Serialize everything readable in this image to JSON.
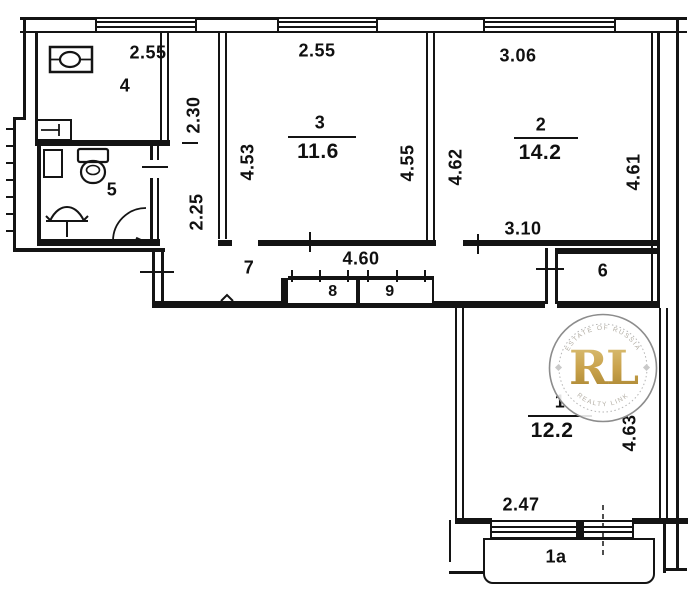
{
  "plan": {
    "rooms": {
      "kitchen": {
        "number": "4",
        "dim_top": "2.55",
        "dim_right": "2.30"
      },
      "room3": {
        "number": "3",
        "area": "11.6",
        "dim_top": "2.55",
        "dim_left": "4.53",
        "dim_right": "4.55"
      },
      "room2": {
        "number": "2",
        "area": "14.2",
        "dim_top": "3.06",
        "dim_left": "4.62",
        "dim_right": "4.61",
        "dim_bottom": "3.10"
      },
      "bathroom": {
        "number": "5"
      },
      "hallway": {
        "number": "7",
        "dim_width": "4.60",
        "dim_height": "2.25"
      },
      "closet_left": {
        "number": "8"
      },
      "closet_right": {
        "number": "9"
      },
      "storage": {
        "number": "6"
      },
      "room1": {
        "number": "1",
        "area": "12.2",
        "dim_right": "4.63",
        "dim_bottom": "2.47"
      },
      "balcony": {
        "number": "1a"
      }
    },
    "watermark": {
      "initials": "RL",
      "arc_top": "ESTATE OF RUSSIA",
      "arc_bottom": "REALTY LINK",
      "gold": "#c29b3d",
      "ring": "#8c8c8c"
    },
    "colors": {
      "line": "#141414",
      "background": "#ffffff"
    }
  }
}
